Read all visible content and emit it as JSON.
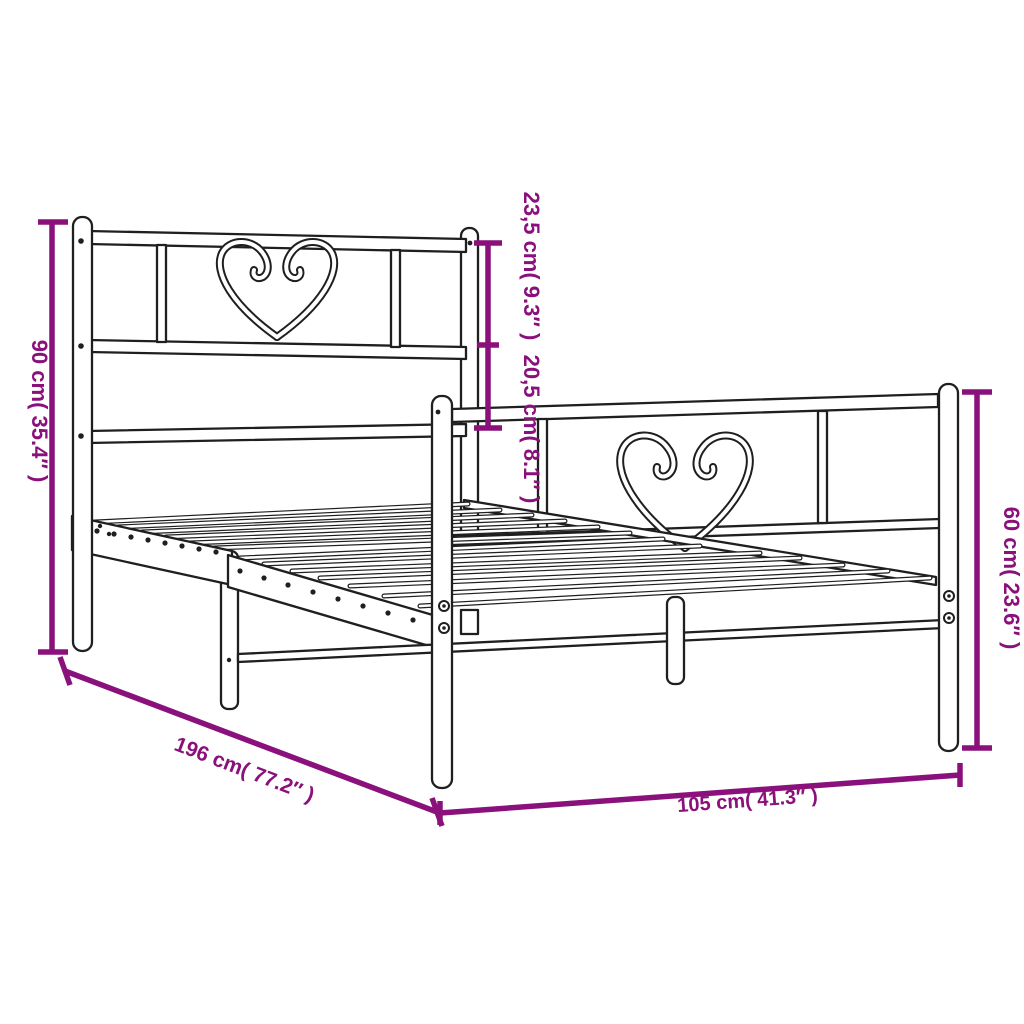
{
  "diagram": {
    "subject": "metal bed frame with heart decorated headboard and footboard",
    "style": "black outline technical drawing on white background",
    "accent_color": "#8a107b",
    "line_color": "#1f1f1f",
    "background_color": "#ffffff"
  },
  "dimensions": {
    "bed_height": {
      "text": "90 cm( 35.4″ )",
      "cm": "90",
      "inches": "35.4",
      "location": "left vertical"
    },
    "headboard_top_section": {
      "text": "23,5 cm( 9.3″ )",
      "cm": "23,5",
      "inches": "9.3",
      "location": "center vertical upper segment"
    },
    "headboard_mid_section": {
      "text": "20,5 cm( 8.1″ )",
      "cm": "20,5",
      "inches": "8.1",
      "location": "center vertical lower segment"
    },
    "footboard_height": {
      "text": "60 cm( 23.6″ )",
      "cm": "60",
      "inches": "23.6",
      "location": "right vertical"
    },
    "bed_length": {
      "text": "196 cm( 77.2″ )",
      "cm": "196",
      "inches": "77.2",
      "location": "bottom-left diagonal"
    },
    "bed_width": {
      "text": "105 cm( 41.3″ )",
      "cm": "105",
      "inches": "41.3",
      "location": "bottom-right horizontal"
    }
  }
}
